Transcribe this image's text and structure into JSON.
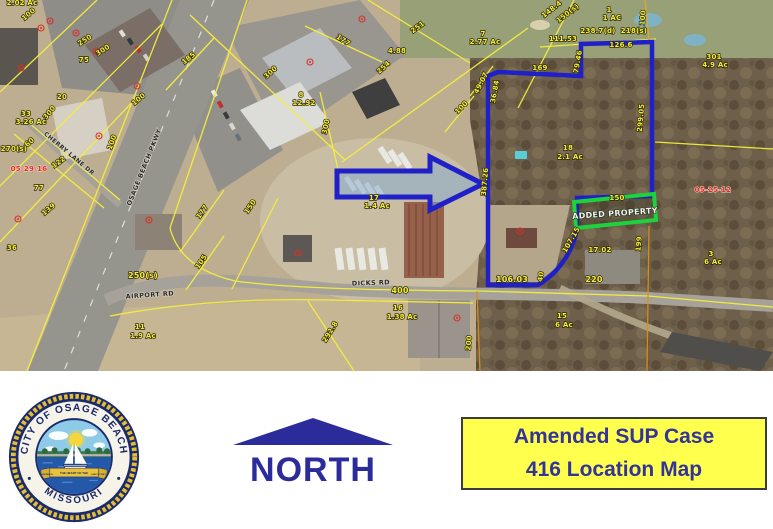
{
  "title_box": {
    "line1": "Amended SUP Case",
    "line2": "416 Location Map",
    "bg": "#ffff4d",
    "text_color": "#333399"
  },
  "north": {
    "label": "NORTH",
    "color": "#2b2b9c"
  },
  "seal": {
    "ring_top": "CITY OF OSAGE BEACH",
    "ring_bottom": "MISSOURI",
    "banner_left": "OSAGE BEACH",
    "banner_center": "THE HEART OF THE",
    "banner_right": "LAKE OF THE OZARKS"
  },
  "map": {
    "added_property_label": "ADDED PROPERTY",
    "boundary_color": "#2020c8",
    "added_property_color": "#1ed23c",
    "parcel_line_color": "#f5ef3a",
    "roads": [
      {
        "name": "OSAGE BEACH PKWY"
      },
      {
        "name": "AIRPORT RD"
      },
      {
        "name": "CHERRY LANE DR"
      },
      {
        "name": "DICKS RD"
      }
    ],
    "labels": [
      {
        "t": "2.02 Ac",
        "x": 22,
        "y": 5
      },
      {
        "t": "100",
        "x": 30,
        "y": 16,
        "r": -40
      },
      {
        "t": "250",
        "x": 86,
        "y": 42,
        "r": -33
      },
      {
        "t": "300",
        "x": 104,
        "y": 52,
        "r": -33
      },
      {
        "t": "75",
        "x": 84,
        "y": 62
      },
      {
        "t": "20",
        "x": 62,
        "y": 99
      },
      {
        "t": "33",
        "x": 26,
        "y": 116
      },
      {
        "t": "3.26 Ac",
        "x": 31,
        "y": 124
      },
      {
        "t": "300",
        "x": 51,
        "y": 114,
        "r": -50
      },
      {
        "t": "60",
        "x": 31,
        "y": 144,
        "r": -42
      },
      {
        "t": "122",
        "x": 60,
        "y": 164,
        "r": -36
      },
      {
        "t": "05-29-16",
        "x": 29,
        "y": 171,
        "c": "red"
      },
      {
        "t": "270(s)",
        "x": 14,
        "y": 151
      },
      {
        "t": "77",
        "x": 39,
        "y": 190
      },
      {
        "t": "139",
        "x": 50,
        "y": 211,
        "r": -40
      },
      {
        "t": "36",
        "x": 12,
        "y": 250
      },
      {
        "t": "100",
        "x": 140,
        "y": 101,
        "r": -40
      },
      {
        "t": "100",
        "x": 114,
        "y": 143,
        "r": -70
      },
      {
        "t": "250(s)",
        "x": 143,
        "y": 278,
        "s": 8
      },
      {
        "t": "105",
        "x": 203,
        "y": 263,
        "r": -55
      },
      {
        "t": "150",
        "x": 252,
        "y": 208,
        "r": -55
      },
      {
        "t": "177",
        "x": 204,
        "y": 213,
        "r": -55
      },
      {
        "t": "185",
        "x": 190,
        "y": 60,
        "r": -38
      },
      {
        "t": "300",
        "x": 272,
        "y": 74,
        "r": -42
      },
      {
        "t": "8",
        "x": 301,
        "y": 97
      },
      {
        "t": "12.92",
        "x": 304,
        "y": 105
      },
      {
        "t": "300",
        "x": 328,
        "y": 127,
        "r": -78
      },
      {
        "t": "254",
        "x": 385,
        "y": 69,
        "r": -42
      },
      {
        "t": "177",
        "x": 342,
        "y": 42,
        "r": 33
      },
      {
        "t": "251",
        "x": 419,
        "y": 29,
        "r": -36
      },
      {
        "t": "4.88",
        "x": 397,
        "y": 53
      },
      {
        "t": "7",
        "x": 483,
        "y": 36
      },
      {
        "t": "2.77 Ac",
        "x": 485,
        "y": 44
      },
      {
        "t": "17",
        "x": 374,
        "y": 200
      },
      {
        "t": "1.4 Ac",
        "x": 377,
        "y": 208
      },
      {
        "t": "49.07",
        "x": 483,
        "y": 84,
        "r": -62
      },
      {
        "t": "36.84",
        "x": 497,
        "y": 92,
        "r": -80
      },
      {
        "t": "100",
        "x": 463,
        "y": 109,
        "r": -45
      },
      {
        "t": "169",
        "x": 540,
        "y": 70
      },
      {
        "t": "79.46",
        "x": 580,
        "y": 62,
        "r": -80
      },
      {
        "t": "111.53",
        "x": 563,
        "y": 41
      },
      {
        "t": "238.7(d)",
        "x": 598,
        "y": 33
      },
      {
        "t": "218(s)",
        "x": 634,
        "y": 33
      },
      {
        "t": "148.4",
        "x": 553,
        "y": 11,
        "r": -38
      },
      {
        "t": "150(s)",
        "x": 569,
        "y": 15,
        "r": -38
      },
      {
        "t": "1",
        "x": 609,
        "y": 12
      },
      {
        "t": "1 AC",
        "x": 612,
        "y": 20
      },
      {
        "t": "100",
        "x": 645,
        "y": 18,
        "r": -85
      },
      {
        "t": "126.6",
        "x": 621,
        "y": 47
      },
      {
        "t": "299.05",
        "x": 643,
        "y": 118,
        "r": -85
      },
      {
        "t": "301",
        "x": 714,
        "y": 59
      },
      {
        "t": "4.9 Ac",
        "x": 715,
        "y": 67
      },
      {
        "t": "05-25-12",
        "x": 713,
        "y": 192,
        "c": "red"
      },
      {
        "t": "18",
        "x": 568,
        "y": 150
      },
      {
        "t": "2.1 Ac",
        "x": 570,
        "y": 159
      },
      {
        "t": "387.26",
        "x": 487,
        "y": 182,
        "r": -85
      },
      {
        "t": "106.03",
        "x": 512,
        "y": 282,
        "s": 8
      },
      {
        "t": "40",
        "x": 543,
        "y": 277,
        "r": -80
      },
      {
        "t": "107.15",
        "x": 573,
        "y": 241,
        "r": -60
      },
      {
        "t": "150",
        "x": 617,
        "y": 200
      },
      {
        "t": "199",
        "x": 641,
        "y": 244,
        "r": -85
      },
      {
        "t": "17.02",
        "x": 600,
        "y": 252
      },
      {
        "t": "220",
        "x": 594,
        "y": 282,
        "s": 8
      },
      {
        "t": "400",
        "x": 400,
        "y": 293,
        "s": 8
      },
      {
        "t": "16",
        "x": 398,
        "y": 310
      },
      {
        "t": "1.38 Ac",
        "x": 402,
        "y": 319
      },
      {
        "t": "200",
        "x": 471,
        "y": 343,
        "r": -85
      },
      {
        "t": "15",
        "x": 562,
        "y": 318
      },
      {
        "t": "6 Ac",
        "x": 564,
        "y": 327
      },
      {
        "t": "292.8",
        "x": 332,
        "y": 333,
        "r": -58
      },
      {
        "t": "11",
        "x": 140,
        "y": 329
      },
      {
        "t": "1.9 Ac",
        "x": 143,
        "y": 338
      },
      {
        "t": "3",
        "x": 711,
        "y": 256
      },
      {
        "t": "6 Ac",
        "x": 713,
        "y": 264
      }
    ],
    "markers": [
      [
        50,
        21
      ],
      [
        41,
        28
      ],
      [
        76,
        33
      ],
      [
        96,
        51
      ],
      [
        137,
        86
      ],
      [
        21,
        68
      ],
      [
        99,
        136
      ],
      [
        310,
        62
      ],
      [
        362,
        19
      ],
      [
        18,
        219
      ],
      [
        149,
        220
      ],
      [
        298,
        253
      ],
      [
        520,
        231
      ],
      [
        457,
        318
      ]
    ]
  }
}
